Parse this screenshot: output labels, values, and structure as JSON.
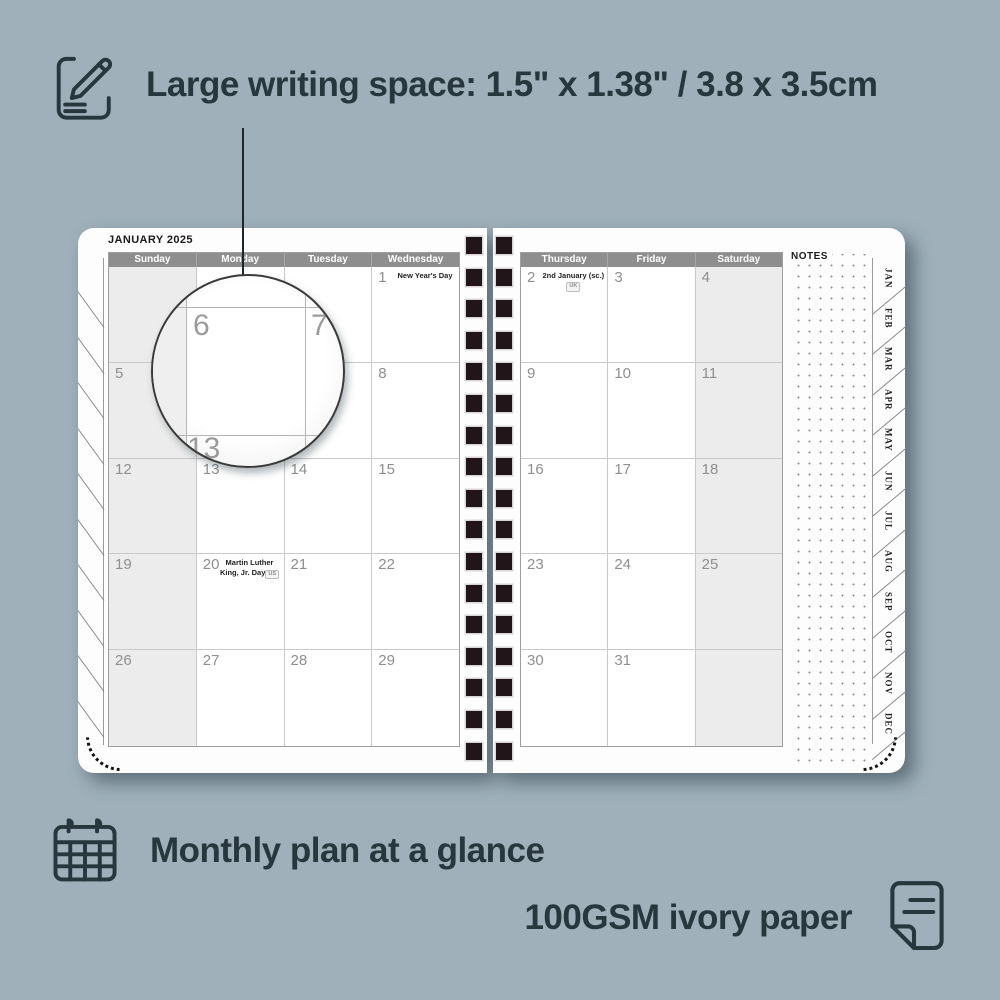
{
  "colors": {
    "background": "#9fb0ba",
    "callout_text": "#28363e",
    "header_bar": "#8e8e8e",
    "shaded_column": "#ececec",
    "page": "#fdfdfd",
    "day_number": "#8f8f8f",
    "binding_hole": "#221519"
  },
  "features": {
    "writing_space": {
      "label": "Large writing space: 1.5\" x 1.38\" / 3.8 x 3.5cm"
    },
    "monthly_plan": {
      "label": "Monthly plan at a glance"
    },
    "paper": {
      "label": "100GSM ivory paper"
    }
  },
  "planner": {
    "month_title": "JANUARY 2025",
    "notes_label": "NOTES",
    "left_page": {
      "day_headers": [
        "Sunday",
        "Monday",
        "Tuesday",
        "Wednesday"
      ],
      "shaded_columns": [
        0
      ],
      "weeks": [
        [
          {
            "day": ""
          },
          {
            "day": ""
          },
          {
            "day": ""
          },
          {
            "day": "1",
            "note": "New Year's Day"
          }
        ],
        [
          {
            "day": "5"
          },
          {
            "day": "6"
          },
          {
            "day": "7"
          },
          {
            "day": "8"
          }
        ],
        [
          {
            "day": "12"
          },
          {
            "day": "13"
          },
          {
            "day": "14"
          },
          {
            "day": "15"
          }
        ],
        [
          {
            "day": "19"
          },
          {
            "day": "20",
            "note": "Martin Luther King, Jr. Day",
            "badge": "US"
          },
          {
            "day": "21"
          },
          {
            "day": "22"
          }
        ],
        [
          {
            "day": "26"
          },
          {
            "day": "27"
          },
          {
            "day": "28"
          },
          {
            "day": "29"
          }
        ]
      ]
    },
    "right_page": {
      "day_headers": [
        "Thursday",
        "Friday",
        "Saturday"
      ],
      "shaded_columns": [
        2
      ],
      "weeks": [
        [
          {
            "day": "2",
            "note": "2nd January (sc.)",
            "badge": "UK"
          },
          {
            "day": "3"
          },
          {
            "day": "4"
          }
        ],
        [
          {
            "day": "9"
          },
          {
            "day": "10"
          },
          {
            "day": "11"
          }
        ],
        [
          {
            "day": "16"
          },
          {
            "day": "17"
          },
          {
            "day": "18"
          }
        ],
        [
          {
            "day": "23"
          },
          {
            "day": "24"
          },
          {
            "day": "25"
          }
        ],
        [
          {
            "day": "30"
          },
          {
            "day": "31"
          },
          {
            "day": ""
          }
        ]
      ]
    },
    "month_tabs": [
      "JAN",
      "FEB",
      "MAR",
      "APR",
      "MAY",
      "JUN",
      "JUL",
      "AUG",
      "SEP",
      "OCT",
      "NOV",
      "DEC"
    ],
    "magnifier": {
      "cell_day": "6",
      "right_day": "7",
      "below_day": "13"
    }
  },
  "binding": {
    "holes_per_column": 17
  }
}
